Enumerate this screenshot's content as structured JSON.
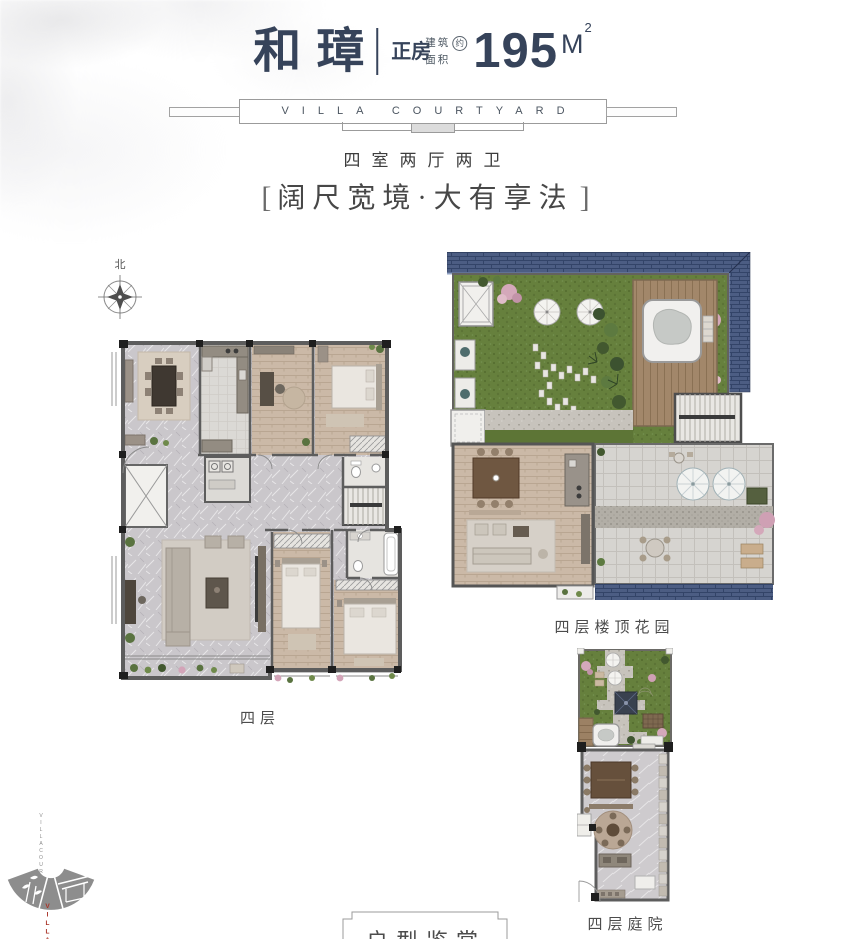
{
  "header": {
    "title": "和璋",
    "type_label": "正房",
    "area_label_top": "建筑",
    "area_label_bottom": "面积",
    "area_approx_badge": "约",
    "area_value": "195",
    "area_unit": "M",
    "area_unit_exp": "2",
    "banner_text": "VILLA COURTYARD",
    "layout_text": "四室两厅两卫",
    "slogan_bracket_left": "[",
    "slogan_text": "阔尺宽境·大有享法",
    "slogan_bracket_right": "]"
  },
  "compass": {
    "label": "北"
  },
  "plans": {
    "main_floor": {
      "label": "四层"
    },
    "roof_garden": {
      "label": "四层楼顶花园"
    },
    "courtyard": {
      "label": "四层庭院"
    }
  },
  "footer": {
    "section_title": "户型鉴赏"
  },
  "brand": {
    "vertical_line1": "VILLA",
    "vertical_line2": "COURTYARD",
    "logo_text": "VILLA"
  },
  "colors": {
    "ink": "#36435a",
    "label_gray": "#4c4c4c",
    "line_gray": "#9b9b9b",
    "brand_red": "#a93226",
    "roof_blue": "#4c5d83",
    "lawn_green": "#66803d",
    "wood": "#cbb9a7",
    "marble": "#cac7cb"
  }
}
